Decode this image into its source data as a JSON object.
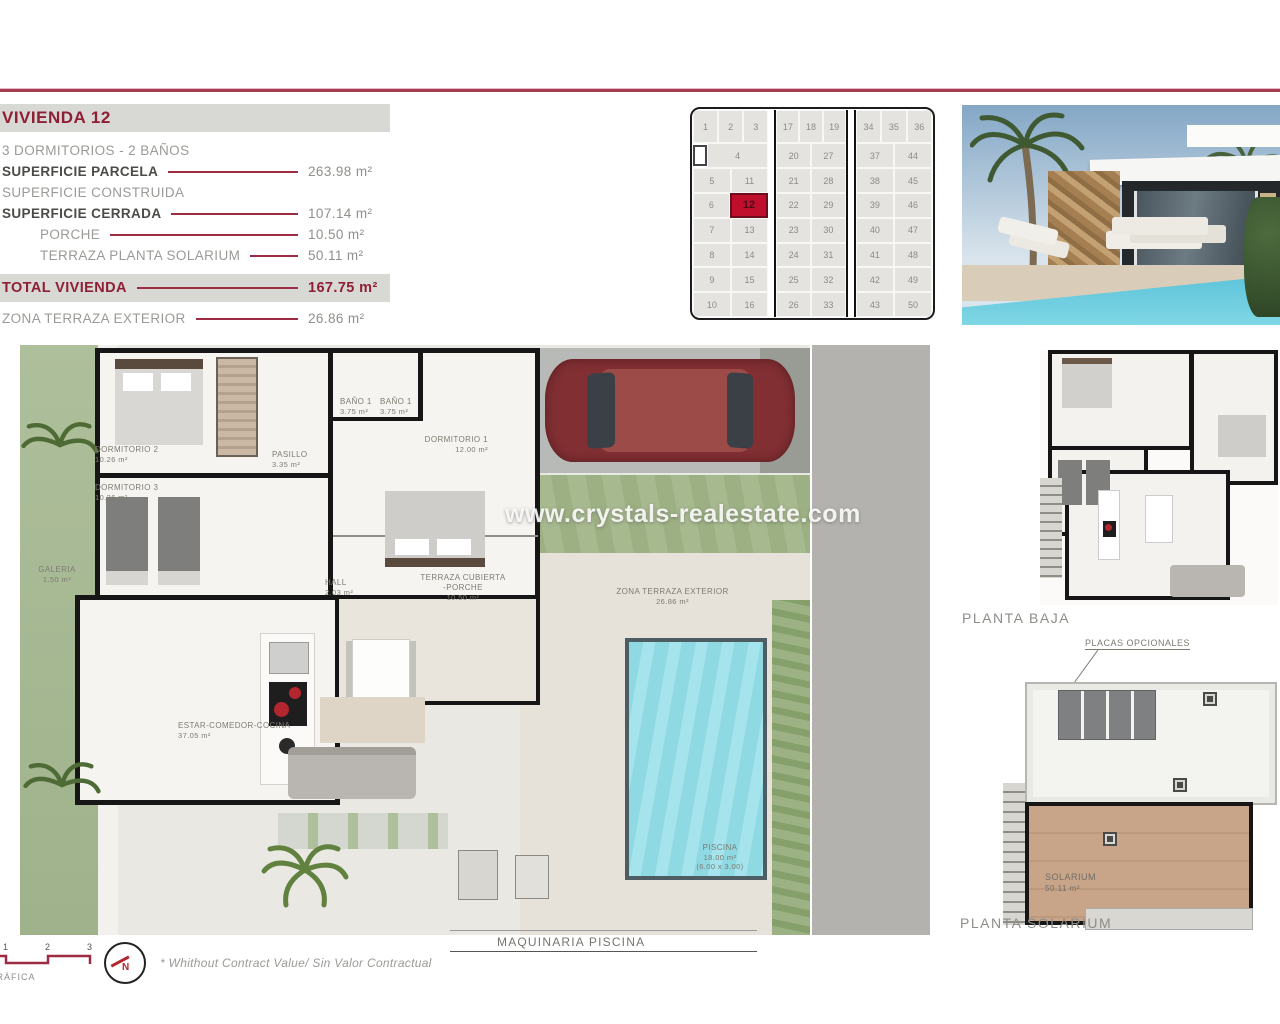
{
  "colors": {
    "accent_red": "#9c2b43",
    "maroon": "#8e1f35",
    "cell_red": "#c00f2d",
    "bar_grey": "#d8d8d5",
    "pool_blue": "#8fd9e3",
    "garden_green": "#aebf9b"
  },
  "info_panel": {
    "title": "VIVIENDA 12",
    "rows": [
      {
        "type": "plain",
        "label": "3 DORMITORIOS - 2 BAÑOS",
        "value": "",
        "line": false
      },
      {
        "type": "strong",
        "label": "SUPERFICIE PARCELA",
        "value": "263.98 m²",
        "line": true
      },
      {
        "type": "plain",
        "label": "SUPERFICIE CONSTRUIDA",
        "value": "",
        "line": false
      },
      {
        "type": "strong",
        "label": "SUPERFICIE CERRADA",
        "value": "107.14 m²",
        "line": true
      },
      {
        "type": "indent",
        "label": "PORCHE",
        "value": "10.50 m²",
        "line": true
      },
      {
        "type": "indent",
        "label": "TERRAZA PLANTA SOLARIUM",
        "value": "50.11 m²",
        "line": true
      },
      {
        "type": "total",
        "label": "TOTAL VIVIENDA",
        "value": "167.75 m²",
        "line": true
      },
      {
        "type": "plain",
        "label": "ZONA TERRAZA EXTERIOR",
        "value": "26.86 m²",
        "line": true
      }
    ]
  },
  "site_grid": {
    "highlighted": "12",
    "blocks": [
      {
        "rows": [
          [
            "1",
            "2",
            "3"
          ],
          [
            "□",
            "4"
          ],
          [
            "5",
            "11"
          ],
          [
            "6",
            "12"
          ],
          [
            "7",
            "13"
          ],
          [
            "8",
            "14"
          ],
          [
            "9",
            "15"
          ],
          [
            "10",
            "16"
          ]
        ]
      },
      {
        "rows": [
          [
            "17",
            "18",
            "19"
          ],
          [
            "20",
            "27"
          ],
          [
            "21",
            "28"
          ],
          [
            "22",
            "29"
          ],
          [
            "23",
            "30"
          ],
          [
            "24",
            "31"
          ],
          [
            "25",
            "32"
          ],
          [
            "26",
            "33"
          ]
        ]
      },
      {
        "rows": [
          [
            "34",
            "35",
            "36"
          ],
          [
            "37",
            "44"
          ],
          [
            "38",
            "45"
          ],
          [
            "39",
            "46"
          ],
          [
            "40",
            "47"
          ],
          [
            "41",
            "48"
          ],
          [
            "42",
            "49"
          ],
          [
            "43",
            "50"
          ]
        ]
      }
    ]
  },
  "floor_plan": {
    "watermark": "www.crystals-realestate.com",
    "maquinaria_label": "MAQUINARIA PISCINA",
    "rooms": [
      {
        "name": "DORMITORIO 2",
        "area": "10.26 m²",
        "x": 75,
        "y": 100,
        "w": 90,
        "align": "left"
      },
      {
        "name": "DORMITORIO 3",
        "area": "10.26 m²",
        "x": 75,
        "y": 138,
        "w": 90,
        "align": "left"
      },
      {
        "name": "PASILLO",
        "area": "3.35 m²",
        "x": 252,
        "y": 105,
        "w": 50,
        "align": "left"
      },
      {
        "name": "BAÑO 1",
        "area": "3.75 m²",
        "x": 320,
        "y": 52,
        "w": 36,
        "align": "left"
      },
      {
        "name": "BAÑO 1",
        "area": "3.75 m²",
        "x": 360,
        "y": 52,
        "w": 36,
        "align": "left"
      },
      {
        "name": "DORMITORIO 1",
        "area": "12.00 m²",
        "x": 378,
        "y": 90,
        "w": 90,
        "align": "right"
      },
      {
        "name": "HALL",
        "area": "2.03 m²",
        "x": 305,
        "y": 233,
        "w": 40,
        "align": "left"
      },
      {
        "name": "TERRAZA CUBIERTA\n-PORCHE",
        "area": "10.50 m²",
        "x": 400,
        "y": 228,
        "w": 86,
        "align": "center"
      },
      {
        "name": "ESTAR-COMEDOR-COCINA",
        "area": "37.05 m²",
        "x": 158,
        "y": 376,
        "w": 130,
        "align": "left"
      },
      {
        "name": "GALERIA",
        "area": "1.50 m²",
        "x": 14,
        "y": 220,
        "w": 46,
        "align": "center"
      },
      {
        "name": "ZONA TERRAZA EXTERIOR",
        "area": "26.86 m²",
        "x": 590,
        "y": 242,
        "w": 125,
        "align": "center"
      },
      {
        "name": "PISCINA",
        "area": "18.00 m²",
        "x": 660,
        "y": 498,
        "w": 80,
        "align": "center",
        "extra": "(6.00 x 3.00)"
      }
    ]
  },
  "side_plans": {
    "baja_label": "PLANTA BAJA",
    "solarium_label": "PLANTA SOLARIUM",
    "placas_label": "PLACAS OPCIONALES",
    "solarium_room": {
      "name": "SOLARIUM",
      "area": "50.11 m²"
    }
  },
  "footer": {
    "scale_ticks": [
      "1",
      "2",
      "3"
    ],
    "scale_label": "ESCALA GRÁFICA",
    "north_letter": "N",
    "disclaimer": "* Whithout Contract Value/ Sin Valor Contractual"
  }
}
